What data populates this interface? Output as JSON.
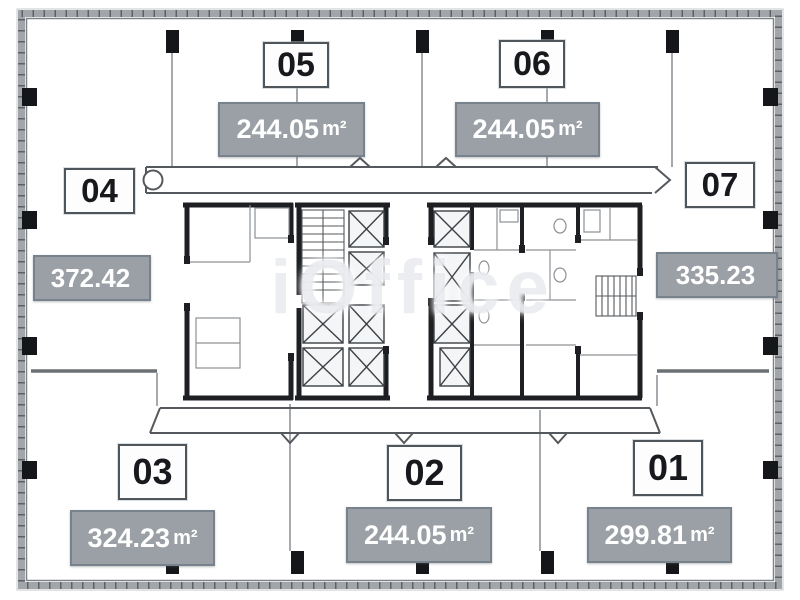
{
  "diagram_type": "office-floor-plan",
  "watermark": "iOffice",
  "units": [
    {
      "id": "01",
      "area": "299.81",
      "unit": "m²"
    },
    {
      "id": "02",
      "area": "244.05",
      "unit": "m²"
    },
    {
      "id": "03",
      "area": "324.23",
      "unit": "m²"
    },
    {
      "id": "04",
      "area": "372.42",
      "unit": ""
    },
    {
      "id": "05",
      "area": "244.05",
      "unit": "m²"
    },
    {
      "id": "06",
      "area": "244.05",
      "unit": "m²"
    },
    {
      "id": "07",
      "area": "335.23",
      "unit": ""
    }
  ],
  "colors": {
    "area_badge_fill": "#9aa0a5",
    "area_badge_border": "#78828c",
    "area_badge_text": "#ffffff",
    "number_badge_fill": "#fdfdfe",
    "number_badge_border": "#4e565c",
    "number_badge_text": "#17191c",
    "outer_wall": "#9aa0a4",
    "core_wall": "#17191c",
    "column": "#141619"
  }
}
